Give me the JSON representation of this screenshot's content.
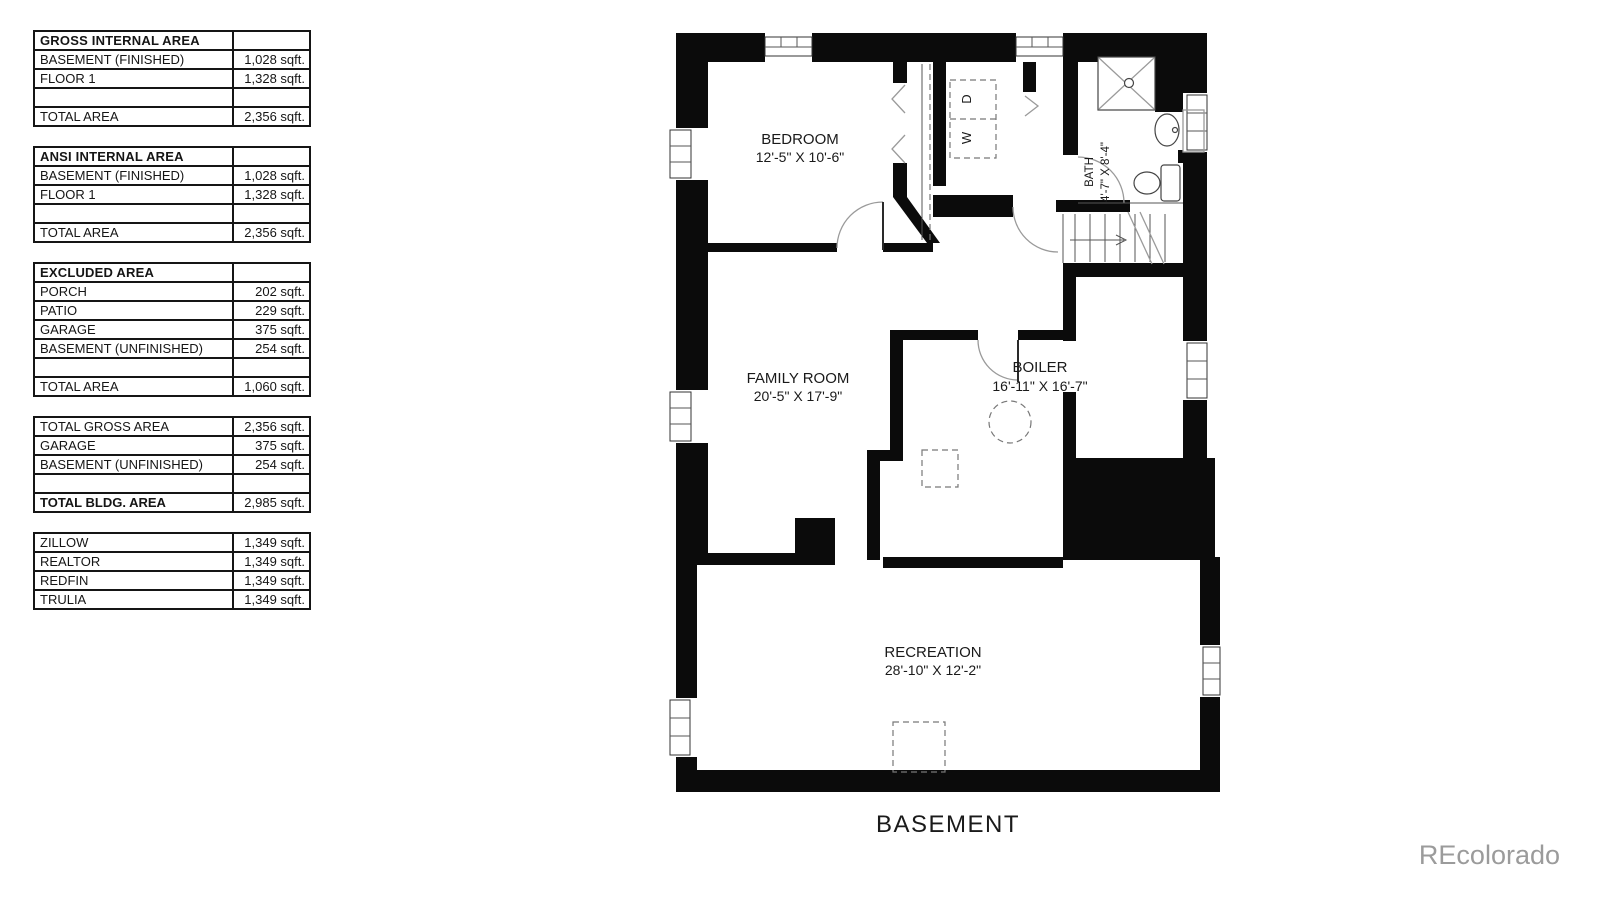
{
  "plan": {
    "title": "BASEMENT",
    "rooms": {
      "bedroom": {
        "name": "BEDROOM",
        "dims": "12'-5\" X 10'-6\""
      },
      "family": {
        "name": "FAMILY ROOM",
        "dims": "20'-5\" X 17'-9\""
      },
      "boiler": {
        "name": "BOILER",
        "dims": "16'-11\" X 16'-7\""
      },
      "recreation": {
        "name": "RECREATION",
        "dims": "28'-10\" X 12'-2\""
      },
      "bath": {
        "name": "BATH",
        "dims": "4'-7\" X 8'-4\""
      }
    },
    "appliances": {
      "washer": "W",
      "dryer": "D"
    }
  },
  "watermark": {
    "text": "REcolorado",
    "color": "#9b9b9b"
  },
  "tables": [
    {
      "header_label": "GROSS INTERNAL AREA",
      "header_value": "",
      "rows": [
        {
          "label": "BASEMENT (FINISHED)",
          "value": "1,028 sqft."
        },
        {
          "label": "FLOOR 1",
          "value": "1,328 sqft."
        },
        {
          "label": "",
          "value": ""
        },
        {
          "label": "TOTAL AREA",
          "value": "2,356 sqft."
        }
      ]
    },
    {
      "header_label": "ANSI INTERNAL AREA",
      "header_value": "",
      "rows": [
        {
          "label": "BASEMENT (FINISHED)",
          "value": "1,028 sqft."
        },
        {
          "label": "FLOOR 1",
          "value": "1,328 sqft."
        },
        {
          "label": "",
          "value": ""
        },
        {
          "label": "TOTAL AREA",
          "value": "2,356 sqft."
        }
      ]
    },
    {
      "header_label": "EXCLUDED AREA",
      "header_value": "",
      "rows": [
        {
          "label": "PORCH",
          "value": "202 sqft."
        },
        {
          "label": "PATIO",
          "value": "229 sqft."
        },
        {
          "label": "GARAGE",
          "value": "375 sqft."
        },
        {
          "label": "BASEMENT (UNFINISHED)",
          "value": "254 sqft."
        },
        {
          "label": "",
          "value": ""
        },
        {
          "label": "TOTAL AREA",
          "value": "1,060 sqft."
        }
      ]
    },
    {
      "rows": [
        {
          "label": "TOTAL GROSS AREA",
          "value": "2,356 sqft."
        },
        {
          "label": "GARAGE",
          "value": "375 sqft."
        },
        {
          "label": "BASEMENT (UNFINISHED)",
          "value": "254 sqft."
        },
        {
          "label": "",
          "value": ""
        },
        {
          "label": "TOTAL BLDG. AREA",
          "value": "2,985 sqft."
        }
      ]
    },
    {
      "rows": [
        {
          "label": "ZILLOW",
          "value": "1,349 sqft."
        },
        {
          "label": "REALTOR",
          "value": "1,349 sqft."
        },
        {
          "label": "REDFIN",
          "value": "1,349 sqft."
        },
        {
          "label": "TRULIA",
          "value": "1,349 sqft."
        }
      ]
    }
  ]
}
